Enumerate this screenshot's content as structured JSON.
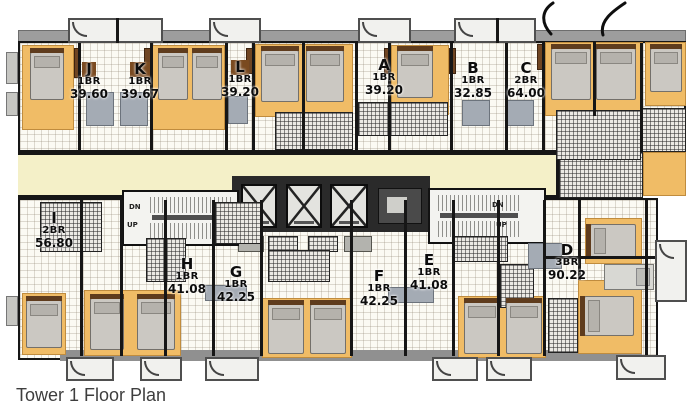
{
  "caption": "Tower 1 Floor Plan",
  "floor_plan": {
    "units": [
      {
        "letter": "J",
        "type": "1BR",
        "area": "39.60"
      },
      {
        "letter": "K",
        "type": "1BR",
        "area": "39.67"
      },
      {
        "letter": "L",
        "type": "1BR",
        "area": "39.20"
      },
      {
        "letter": "A",
        "type": "1BR",
        "area": "39.20"
      },
      {
        "letter": "B",
        "type": "1BR",
        "area": "32.85"
      },
      {
        "letter": "C",
        "type": "2BR",
        "area": "64.00"
      },
      {
        "letter": "I",
        "type": "2BR",
        "area": "56.80"
      },
      {
        "letter": "H",
        "type": "1BR",
        "area": "41.08"
      },
      {
        "letter": "G",
        "type": "1BR",
        "area": "42.25"
      },
      {
        "letter": "F",
        "type": "1BR",
        "area": "42.25"
      },
      {
        "letter": "E",
        "type": "1BR",
        "area": "41.08"
      },
      {
        "letter": "D",
        "type": "3BR",
        "area": "90.22"
      }
    ],
    "stair_labels": {
      "dn": "DN",
      "up": "UP"
    },
    "colors": {
      "bedroom": "#f0bc66",
      "corridor": "#f4f0c8",
      "wall": "#161616",
      "balcony": "#f1f1ee",
      "bed": "#cbc8c2",
      "caption_text": "#3e3e3e"
    }
  }
}
